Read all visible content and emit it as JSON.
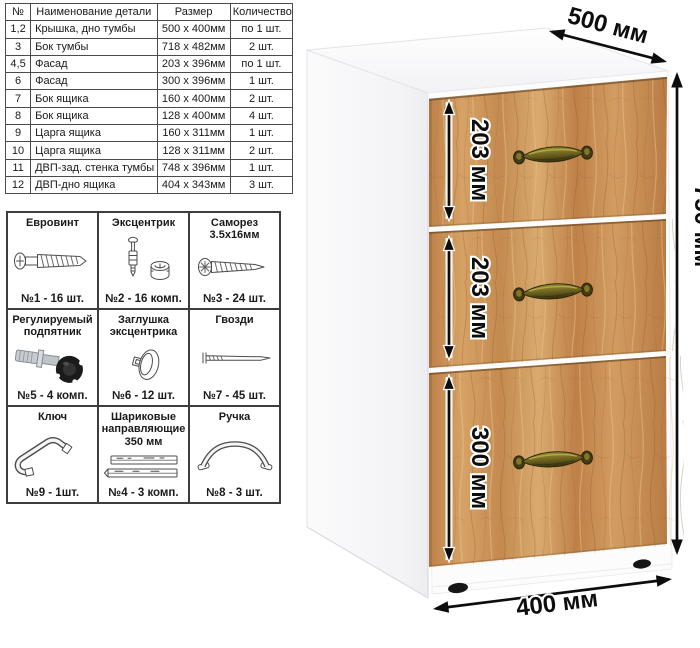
{
  "parts_table": {
    "headers": [
      "№",
      "Наименование детали",
      "Размер",
      "Количество"
    ],
    "rows": [
      [
        "1,2",
        "Крышка, дно тумбы",
        "500 х 400мм",
        "по 1 шт."
      ],
      [
        "3",
        "Бок тумбы",
        "718 х 482мм",
        "2 шт."
      ],
      [
        "4,5",
        "Фасад",
        "203 х 396мм",
        "по 1 шт."
      ],
      [
        "6",
        "Фасад",
        "300 х 396мм",
        "1 шт."
      ],
      [
        "7",
        "Бок ящика",
        "160 х 400мм",
        "2 шт."
      ],
      [
        "8",
        "Бок ящика",
        "128 х 400мм",
        "4 шт."
      ],
      [
        "9",
        "Царга ящика",
        "160 х 311мм",
        "1 шт."
      ],
      [
        "10",
        "Царга ящика",
        "128 х 311мм",
        "2 шт."
      ],
      [
        "11",
        "ДВП-зад. стенка тумбы",
        "748 х 396мм",
        "1 шт."
      ],
      [
        "12",
        "ДВП-дно ящика",
        "404 х 343мм",
        "3 шт."
      ]
    ]
  },
  "hardware": {
    "items": [
      {
        "name": "Евровинт",
        "count": "№1 - 16 шт.",
        "icon": "confirmat-screw-icon"
      },
      {
        "name": "Эксцентрик",
        "count": "№2 - 16 комп.",
        "icon": "cam-lock-icon"
      },
      {
        "name": "Саморез 3.5х16мм",
        "count": "№3 - 24 шт.",
        "icon": "self-tapping-screw-icon"
      },
      {
        "name": "Регулируемый подпятник",
        "count": "№5 - 4 комп.",
        "icon": "adjustable-foot-icon"
      },
      {
        "name": "Заглушка эксцентрика",
        "count": "№6 - 12 шт.",
        "icon": "cam-cover-icon"
      },
      {
        "name": "Гвозди",
        "count": "№7 - 45 шт.",
        "icon": "nail-icon"
      },
      {
        "name": "Ключ",
        "count": "№9 - 1шт.",
        "icon": "hex-key-icon"
      },
      {
        "name": "Шариковые направляющие 350 мм",
        "count": "№4 - 3 комп.",
        "icon": "drawer-slides-icon"
      },
      {
        "name": "Ручка",
        "count": "№8 - 3 шт.",
        "icon": "handle-icon"
      }
    ]
  },
  "cabinet": {
    "dims": {
      "depth": "500 мм",
      "height": "750 мм",
      "width": "400 мм",
      "drawer1": "203 мм",
      "drawer2": "203 мм",
      "drawer3": "300 мм"
    },
    "colors": {
      "wood": "#c98f54",
      "wood_dark": "#9c6a39",
      "wood_light": "#dcab71",
      "handle_brass": "#7a7026",
      "body_white": "#ffffff",
      "dimension_black": "#0d0d0d"
    }
  }
}
